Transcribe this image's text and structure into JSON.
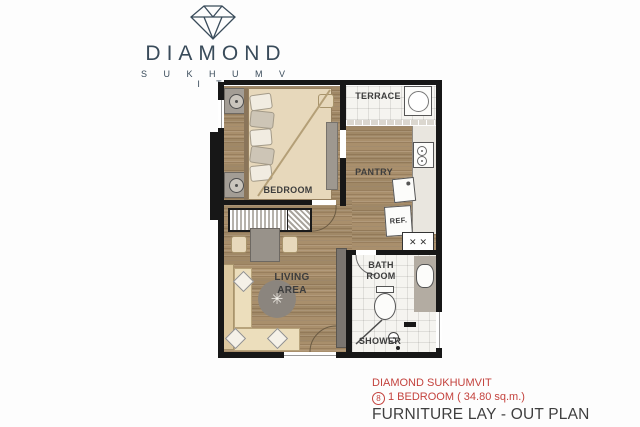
{
  "logo": {
    "brand": "DIAMOND",
    "subtitle": "S U K H U M V I T"
  },
  "plan": {
    "labels": {
      "terrace": "TERRACE",
      "bedroom": "BEDROOM",
      "pantry": "PANTRY",
      "refrigerator": "REF.",
      "living": "LIVING AREA",
      "bathroom": "BATH ROOM",
      "shower": "SHOWER"
    }
  },
  "caption": {
    "project": "DIAMOND SUKHUMVIT",
    "unit_number": "8",
    "unit_details": "1 BEDROOM ( 34.80 sq.m.)",
    "title": "FURNITURE LAY - OUT PLAN"
  },
  "icons": {
    "plant": "✳",
    "entry_door": "✕✕"
  },
  "colors": {
    "brand_navy": "#394b5a",
    "accent_red": "#c4433e",
    "wall": "#171717",
    "wood": "#a98f6c",
    "tile": "#f5f4f0",
    "beige": "#e7d8bb",
    "gray_furniture": "#98928a",
    "label": "#3d3d3d"
  }
}
